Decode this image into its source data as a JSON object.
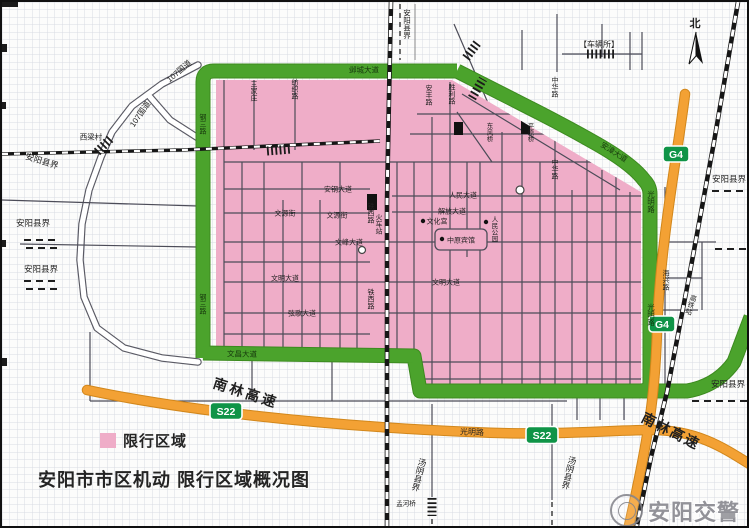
{
  "title": {
    "text": "安阳市市区机动 限行区域概况图"
  },
  "legend": {
    "label": "限行区域"
  },
  "watermark": {
    "text": "安阳交警"
  },
  "colors": {
    "pink": "#efadc8",
    "green": "#4ba32c",
    "green_casing": "#3c8a1f",
    "orange": "#f3a134",
    "orange_casing": "#d2871b",
    "badge": "#0f9447",
    "grid": "#d9dbe3",
    "street": "#4c4c58",
    "rail": "#161616",
    "text": "#1f1f1f",
    "green_text": "#16380d",
    "watermark": "#85858c"
  },
  "badges": [
    {
      "n": "g4-badge-top",
      "t": "G4",
      "x": 674,
      "y": 152,
      "w": 26,
      "h": 16
    },
    {
      "n": "g4-badge-bottom",
      "t": "G4",
      "x": 660,
      "y": 322,
      "w": 26,
      "h": 16
    },
    {
      "n": "s22-badge-left",
      "t": "S22",
      "x": 224,
      "y": 409,
      "w": 32,
      "h": 17
    },
    {
      "n": "s22-badge-right",
      "t": "S22",
      "x": 540,
      "y": 433,
      "w": 32,
      "h": 17
    }
  ],
  "poi_dots": [
    {
      "n": "culture-palace-dot",
      "x": 421,
      "y": 219
    },
    {
      "n": "renmin-park-dot",
      "x": 484,
      "y": 220
    },
    {
      "n": "zhongyuan-hotel-dot",
      "x": 440,
      "y": 237
    }
  ],
  "labels": [
    {
      "n": "north-label",
      "t": "北",
      "x": 693,
      "y": 21,
      "s": 11,
      "b": true
    },
    {
      "n": "vehicle-office-label",
      "t": "【车辆所】",
      "x": 597,
      "y": 42,
      "s": 8
    },
    {
      "n": "anyang-boundary-top",
      "t": "安阳县界",
      "x": 405,
      "y": 22,
      "s": 7.5,
      "v": true
    },
    {
      "n": "yecheng-avenue-label",
      "t": "邺城大道",
      "x": 362,
      "y": 68,
      "s": 7.5,
      "c": "green_text"
    },
    {
      "n": "anzhang-avenue-label",
      "t": "安漳大道",
      "x": 612,
      "y": 150,
      "s": 7.5,
      "r": 33,
      "c": "green_text"
    },
    {
      "n": "guangming-road-green-1",
      "t": "光明路",
      "x": 649,
      "y": 200,
      "s": 7.5,
      "v": true,
      "c": "green_text"
    },
    {
      "n": "guangming-road-green-2",
      "t": "光明路",
      "x": 649,
      "y": 313,
      "s": 7.5,
      "v": true,
      "c": "green_text"
    },
    {
      "n": "gangsan-road-1",
      "t": "钢三路",
      "x": 201,
      "y": 122,
      "s": 7,
      "v": true,
      "c": "green_text"
    },
    {
      "n": "gangsan-road-2",
      "t": "钢三路",
      "x": 201,
      "y": 302,
      "s": 7,
      "v": true,
      "c": "green_text"
    },
    {
      "n": "wenchang-avenue-green-label",
      "t": "文昌大道",
      "x": 240,
      "y": 352,
      "s": 7.5,
      "r": 1,
      "c": "green_text"
    },
    {
      "n": "g107-label-1",
      "t": "107国道",
      "x": 177,
      "y": 69,
      "s": 8,
      "r": -40
    },
    {
      "n": "g107-label-2",
      "t": "107国道",
      "x": 138,
      "y": 112,
      "s": 8,
      "r": -55
    },
    {
      "n": "xiliang-village-label",
      "t": "西梁村",
      "x": 89,
      "y": 135,
      "s": 7.5
    },
    {
      "n": "anyang-boundary-nw",
      "t": "安阳县界",
      "x": 40,
      "y": 159,
      "s": 8.5,
      "r": 17
    },
    {
      "n": "anyang-boundary-w1",
      "t": "安阳县界",
      "x": 31,
      "y": 221,
      "s": 8.5
    },
    {
      "n": "anyang-boundary-w2",
      "t": "安阳县界",
      "x": 39,
      "y": 267,
      "s": 8.5
    },
    {
      "n": "anyang-boundary-e1",
      "t": "安阳县界",
      "x": 727,
      "y": 177,
      "s": 8.5
    },
    {
      "n": "anyang-boundary-se",
      "t": "安阳县界",
      "x": 726,
      "y": 382,
      "s": 8.5
    },
    {
      "n": "tangyin-boundary-1",
      "t": "汤阴县界",
      "x": 417,
      "y": 473,
      "s": 8.5,
      "v": true,
      "r": 14
    },
    {
      "n": "tangyin-boundary-2",
      "t": "汤阴县界",
      "x": 567,
      "y": 471,
      "s": 8.5,
      "v": true,
      "r": 14
    },
    {
      "n": "nanlin-expressway-1",
      "t": "南林高速",
      "x": 244,
      "y": 391,
      "s": 14,
      "b": true,
      "r": 18,
      "ls": 3
    },
    {
      "n": "nanlin-expressway-2",
      "t": "南林高速",
      "x": 669,
      "y": 429,
      "s": 14,
      "b": true,
      "r": 27,
      "ls": 2
    },
    {
      "n": "guangming-road-orange-label",
      "t": "光明路",
      "x": 470,
      "y": 430,
      "s": 8,
      "r": 2
    },
    {
      "n": "sanjiazhuang-label",
      "t": "三家庄",
      "x": 252,
      "y": 89,
      "s": 7,
      "v": true
    },
    {
      "n": "fangzhi-road-label",
      "t": "纺织路",
      "x": 293,
      "y": 87,
      "s": 7,
      "v": true
    },
    {
      "n": "anfeng-road-label",
      "t": "安丰路",
      "x": 427,
      "y": 93,
      "s": 7,
      "v": true
    },
    {
      "n": "shengli-road-label",
      "t": "胜利路",
      "x": 450,
      "y": 92,
      "s": 7,
      "v": true
    },
    {
      "n": "zhonghua-road-1",
      "t": "中华路",
      "x": 553,
      "y": 85,
      "s": 7,
      "v": true
    },
    {
      "n": "zhonghua-road-2",
      "t": "中华路",
      "x": 553,
      "y": 167,
      "s": 7,
      "v": true
    },
    {
      "n": "angang-avenue-label",
      "t": "安钢大道",
      "x": 336,
      "y": 187,
      "s": 7
    },
    {
      "n": "wenyuan-street-1",
      "t": "文源街",
      "x": 283,
      "y": 211,
      "s": 7
    },
    {
      "n": "wenyuan-street-2",
      "t": "文源街",
      "x": 335,
      "y": 213,
      "s": 7
    },
    {
      "n": "wenfeng-avenue-label",
      "t": "文峰大道",
      "x": 347,
      "y": 240,
      "s": 7
    },
    {
      "n": "wenming-avenue-1",
      "t": "文明大道",
      "x": 283,
      "y": 276,
      "s": 7
    },
    {
      "n": "wenming-avenue-2",
      "t": "文明大道",
      "x": 444,
      "y": 280,
      "s": 7
    },
    {
      "n": "xiange-avenue-label",
      "t": "弦歌大道",
      "x": 300,
      "y": 311,
      "s": 7
    },
    {
      "n": "jiefang-avenue-label",
      "t": "解放大道",
      "x": 450,
      "y": 209,
      "s": 7
    },
    {
      "n": "renmin-avenue-label",
      "t": "人民大道",
      "x": 461,
      "y": 193,
      "s": 7
    },
    {
      "n": "tiexi-road-1",
      "t": "铁西路",
      "x": 369,
      "y": 211,
      "s": 7,
      "v": true
    },
    {
      "n": "tiexi-road-2",
      "t": "铁西路",
      "x": 369,
      "y": 297,
      "s": 7,
      "v": true
    },
    {
      "n": "railway-station-label",
      "t": "火车站",
      "x": 377,
      "y": 222,
      "s": 7,
      "v": true
    },
    {
      "n": "culture-palace-label",
      "t": "文化宫",
      "x": 435,
      "y": 219,
      "s": 7
    },
    {
      "n": "renmin-park-label",
      "t": "人民公园",
      "x": 493,
      "y": 227,
      "s": 6.5,
      "v": true
    },
    {
      "n": "zhongyuan-hotel-label",
      "t": "中原宾馆",
      "x": 459,
      "y": 238,
      "s": 7
    },
    {
      "n": "dongfeng-bridge-label",
      "t": "东风桥",
      "x": 488,
      "y": 130,
      "s": 6.5,
      "v": true
    },
    {
      "n": "pingyuan-bridge-label",
      "t": "平原桥",
      "x": 529,
      "y": 130,
      "s": 6.5,
      "v": true
    },
    {
      "n": "haixing-road-label",
      "t": "海兴路",
      "x": 664,
      "y": 278,
      "s": 7,
      "v": true
    },
    {
      "n": "hsr-station-label",
      "t": "高铁站",
      "x": 689,
      "y": 303,
      "s": 7,
      "v": true,
      "r": 18
    },
    {
      "n": "menghe-bridge-label",
      "t": "孟河桥",
      "x": 404,
      "y": 501,
      "s": 6.5
    }
  ]
}
